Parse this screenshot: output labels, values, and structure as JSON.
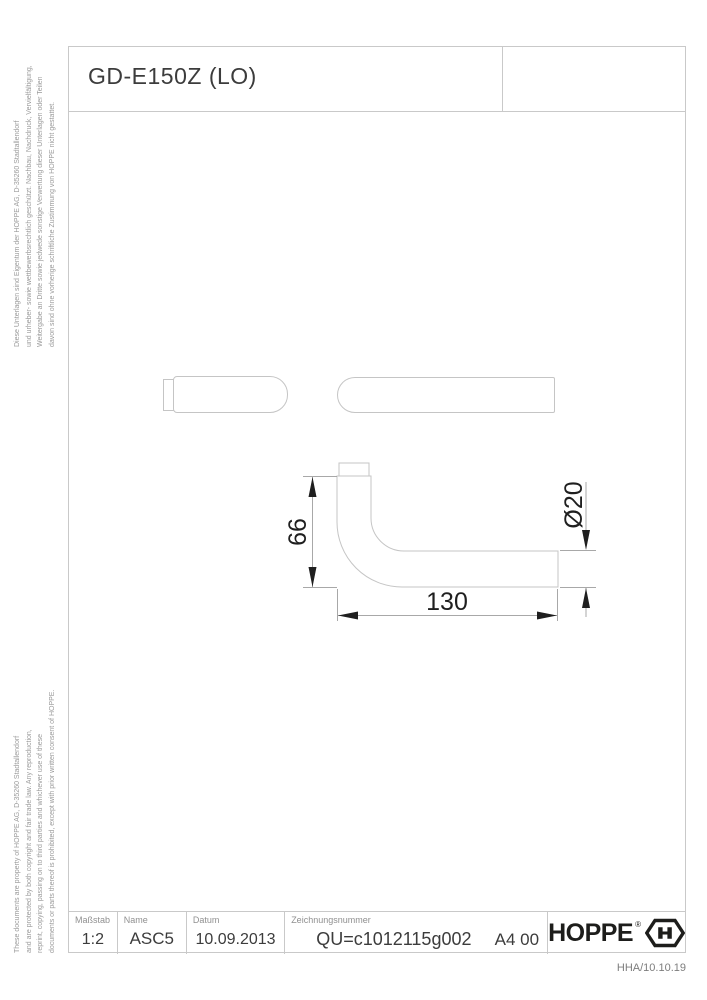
{
  "title": "GD-E150Z (LO)",
  "legal": {
    "german_lines": [
      "Diese Unterlagen sind Eigentum der HOPPE AG, D-35260 Stadtallendorf",
      "und urheber- sowie wettbewerbsrechtlich geschützt. Nachbau, Nachdruck, Vervielfältigung,",
      "Weitergabe an Dritte sowie jedwede sonstige Verwertung dieser Unterlagen oder Teilen",
      "davon sind ohne vorherige schriftliche Zustimmung von HOPPE nicht gestattet."
    ],
    "english_lines": [
      "These documents are property of HOPPE AG, D-35260 Stadtallendorf",
      "and are protected by both copyright and fair trade law. Any reproduction,",
      "reprint, copying, passing on to third parties and whichever use of these",
      "documents or parts thereof is prohibited, except with prior written consent of HOPPE."
    ]
  },
  "drawing": {
    "dimensions": {
      "height_mm": "66",
      "length_mm": "130",
      "diameter": "Ø20"
    }
  },
  "title_block": {
    "masstab_label": "Maßstab",
    "masstab_value": "1:2",
    "name_label": "Name",
    "name_value": "ASC5",
    "datum_label": "Datum",
    "datum_value": "10.09.2013",
    "zeichnungsnummer_label": "Zeichnungsnummer",
    "zeichnungsnummer_value": "QU=c1012115g002",
    "format_value": "A4 00",
    "brand": "HOPPE",
    "registered": "®"
  },
  "revision": "HHA/10.10.19",
  "colors": {
    "frame_line": "#c9c9c9",
    "part_outline": "#c5c5c5",
    "dimension_line": "#a8a8a8",
    "dimension_text": "#1f1f1f",
    "text_dark": "#3c3c3c",
    "text_gray": "#909090",
    "logo": "#1d1d1b"
  }
}
